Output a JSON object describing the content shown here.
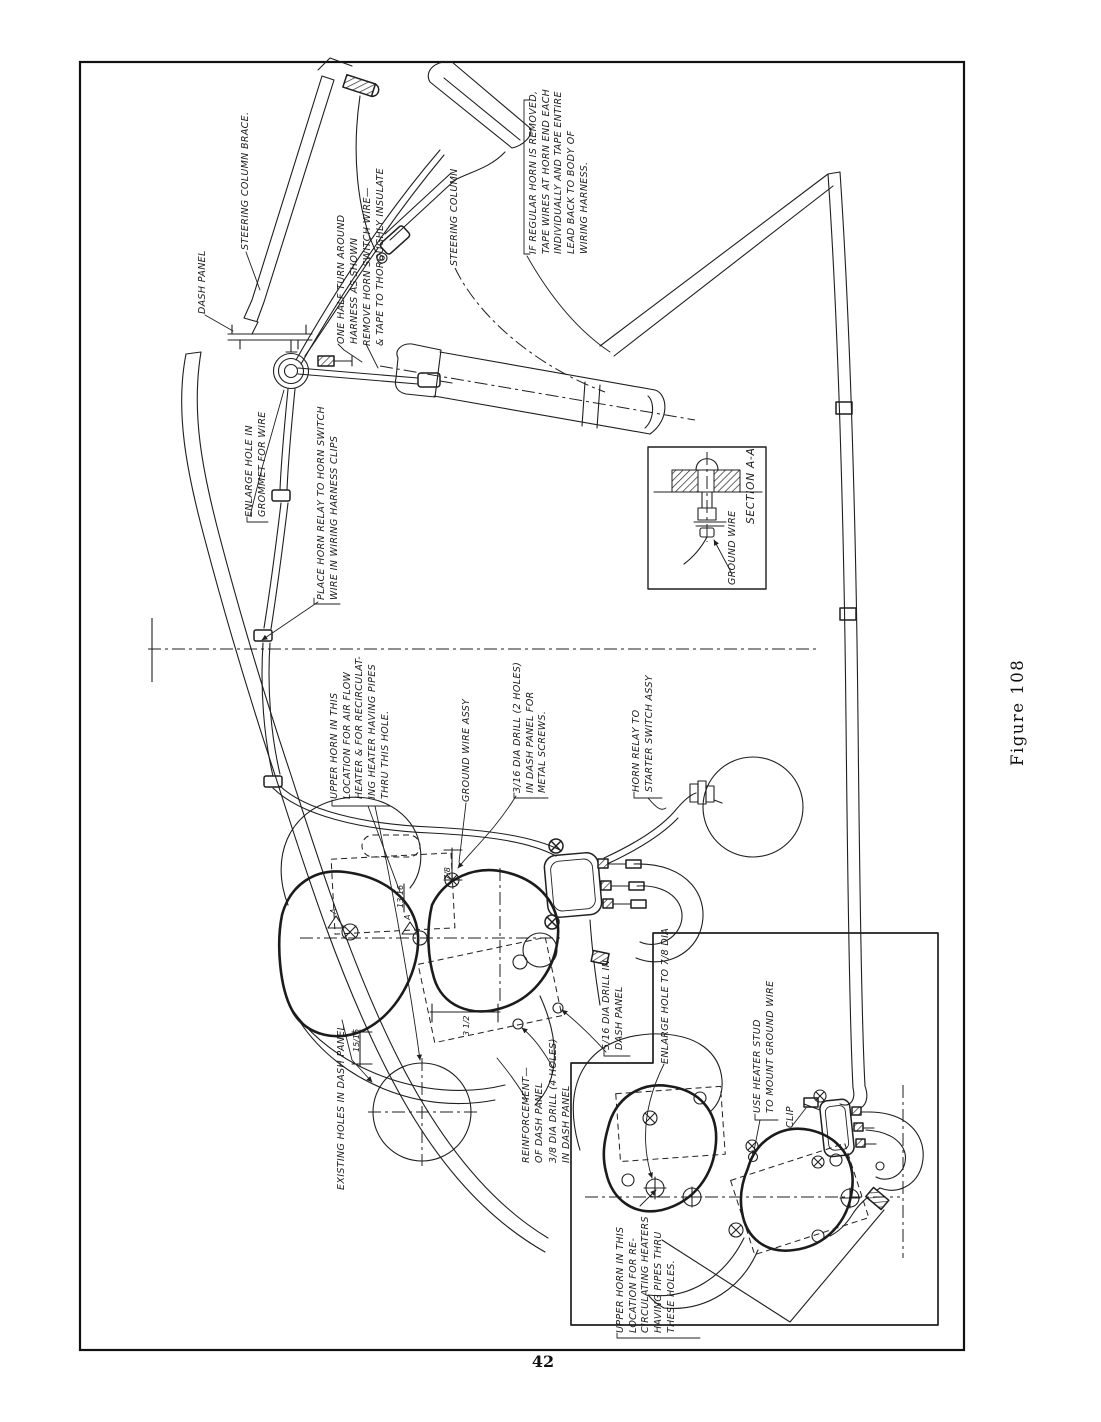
{
  "page": {
    "number": "42",
    "figure_caption": "Figure 108"
  },
  "ink": {
    "line": "#1f1f1f",
    "paper": "#ffffff"
  },
  "labels": {
    "dash_panel": "DASH PANEL",
    "steering_column_brace": "STEERING COLUMN BRACE.",
    "half_turn": "ONE HALF TURN AROUND\nHARNESS AS SHOWN",
    "remove_wire": "REMOVE HORN SWITCH WIRE—\n& TAPE TO THOROUGHLY INSULATE",
    "steering_column": "STEERING COLUMN",
    "regular_horn_note": "IF REGULAR HORN IS REMOVED,\nTAPE WIRES AT HORN END EACH\nINDIVIDUALLY AND TAPE ENTIRE\nLEAD BACK TO BODY OF\nWIRING HARNESS.",
    "enlarge_grommet": "ENLARGE HOLE IN\nGROMMET FOR WIRE",
    "harness_clips": "PLACE HORN RELAY TO HORN SWITCH\nWIRE IN WIRING HARNESS CLIPS",
    "upper_horn_main": "UPPER HORN IN THIS\nLOCATION FOR AIR FLOW\nHEATER & FOR RECIRCULAT-\nING HEATER HAVING PIPES\nTHRU THIS HOLE.",
    "ground_wire_assy": "GROUND WIRE ASSY",
    "drill_2_holes": "3/16 DIA DRILL (2 HOLES)\nIN DASH PANEL FOR\nMETAL SCREWS.",
    "relay_to_starter": "HORN RELAY TO\nSTARTER SWITCH ASSY",
    "ground_wire": "GROUND WIRE",
    "section_aa": "SECTION A-A",
    "drill_dash": "5/16 DIA DRILL IN\nDASH PANEL",
    "enlarge_78": "ENLARGE HOLE TO 7/8 DIA",
    "heater_stud": "USE HEATER STUD\nTO MOUNT GROUND WIRE",
    "clip": "CLIP",
    "reinforcement": "REINFORCEMENT—\nOF DASH PANEL",
    "drill_4_holes": "3/8 DIA DRILL (4 HOLES)\nIN DASH PANEL",
    "existing_holes": "EXISTING HOLES IN DASH PANEL",
    "upper_horn_inset": "UPPER HORN IN THIS\nLOCATION FOR RE-\nCIRCULATING HEATERS\nHAVING PIPES THRU\nTHESE HOLES."
  },
  "dims": [
    {
      "text": "7/8"
    },
    {
      "text": "15/16"
    },
    {
      "text": "3 1/2"
    },
    {
      "text": "13/16"
    },
    {
      "text": "A"
    },
    {
      "text": "A"
    }
  ]
}
